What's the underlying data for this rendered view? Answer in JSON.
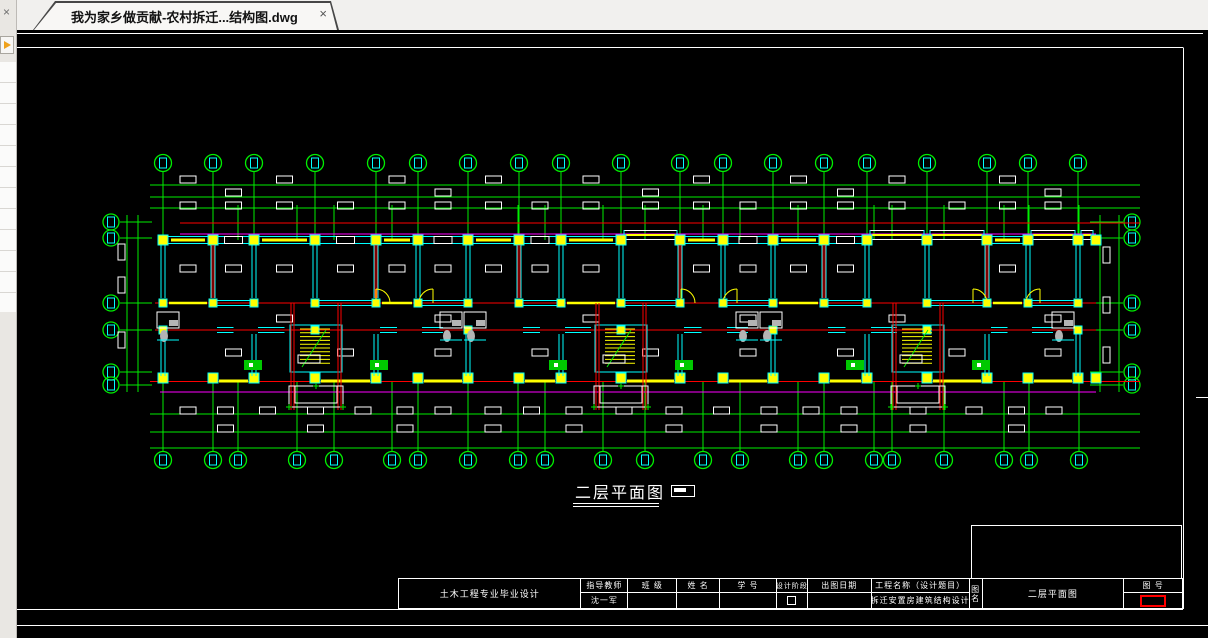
{
  "window": {
    "tab_title": "我为家乡做贡献-农村拆迁...结构图.dwg",
    "tab_close_glyph": "×",
    "panel_close_glyph": "×"
  },
  "plan_label": {
    "text": "二层平面图"
  },
  "title_block": {
    "project": "土木工程专业毕业设计",
    "advisor_label": "指导教师",
    "advisor_value": "沈一军",
    "class_label": "班 级",
    "class_value": "",
    "name_label": "姓 名",
    "name_value": "",
    "id_label": "学 号",
    "id_value": "",
    "stage_label": "设计阶段",
    "date_label": "出图日期",
    "date_value": "",
    "proj_name_label": "工程名称（设计题目）",
    "proj_name_value": "拆迁安置房建筑结构设计",
    "fig_label": "图名",
    "fig_value": "二层平面图",
    "no_label": "图  号",
    "no_value": ""
  },
  "colors": {
    "background": "#000000",
    "grid_green": "#00ee00",
    "wall_cyan": "#00ffff",
    "beam_yellow": "#ffff00",
    "line_red": "#ff0000",
    "dim_magenta": "#ff00ff",
    "text_white": "#ffffff",
    "fixture_gray": "#b4b4b4",
    "stove_green": "#00c800",
    "highlight_red": "#ff0000",
    "chrome_bg": "#f1f0ee"
  },
  "plan": {
    "axes_x": [
      163,
      213,
      254,
      315,
      376,
      418,
      468,
      519,
      561,
      621,
      680,
      723,
      773,
      824,
      867,
      927,
      987,
      1028,
      1078
    ],
    "axes_x_bottom": [
      163,
      213,
      238,
      297,
      334,
      392,
      418,
      468,
      518,
      545,
      603,
      645,
      703,
      740,
      798,
      824,
      874,
      892,
      944,
      1004,
      1029,
      1079
    ],
    "axes_y": [
      222,
      238,
      303,
      330,
      372,
      385
    ],
    "top_bubble_y": 163,
    "bottom_bubble_y": 460,
    "left_bubble_x": 111,
    "right_bubble_x": 1132,
    "top_dim_ys": [
      185,
      197,
      208
    ],
    "bottom_dim_ys": [
      414,
      432
    ],
    "bottom_extra_line_y": 448,
    "left_dim_xs": [
      127,
      138
    ],
    "right_dim_xs": [
      1100,
      1119
    ],
    "building": {
      "left": 155,
      "right": 1096,
      "top": 240,
      "mid1": 303,
      "mid2": 330,
      "bottom": 381
    },
    "stairs_x": [
      316,
      621,
      918
    ],
    "bays": [
      [
        621,
        680
      ],
      [
        867,
        927
      ],
      [
        927,
        987
      ],
      [
        1028,
        1096
      ]
    ],
    "bath_x": [
      157,
      440,
      464,
      736,
      760,
      1052
    ],
    "door_arcs": [
      {
        "x": 376,
        "y": 303,
        "r": 14,
        "dir": 1
      },
      {
        "x": 433,
        "y": 303,
        "r": 14,
        "dir": 0
      },
      {
        "x": 681,
        "y": 303,
        "r": 14,
        "dir": 1
      },
      {
        "x": 737,
        "y": 303,
        "r": 14,
        "dir": 0
      },
      {
        "x": 973,
        "y": 303,
        "r": 14,
        "dir": 1
      },
      {
        "x": 1040,
        "y": 303,
        "r": 14,
        "dir": 0
      }
    ]
  }
}
